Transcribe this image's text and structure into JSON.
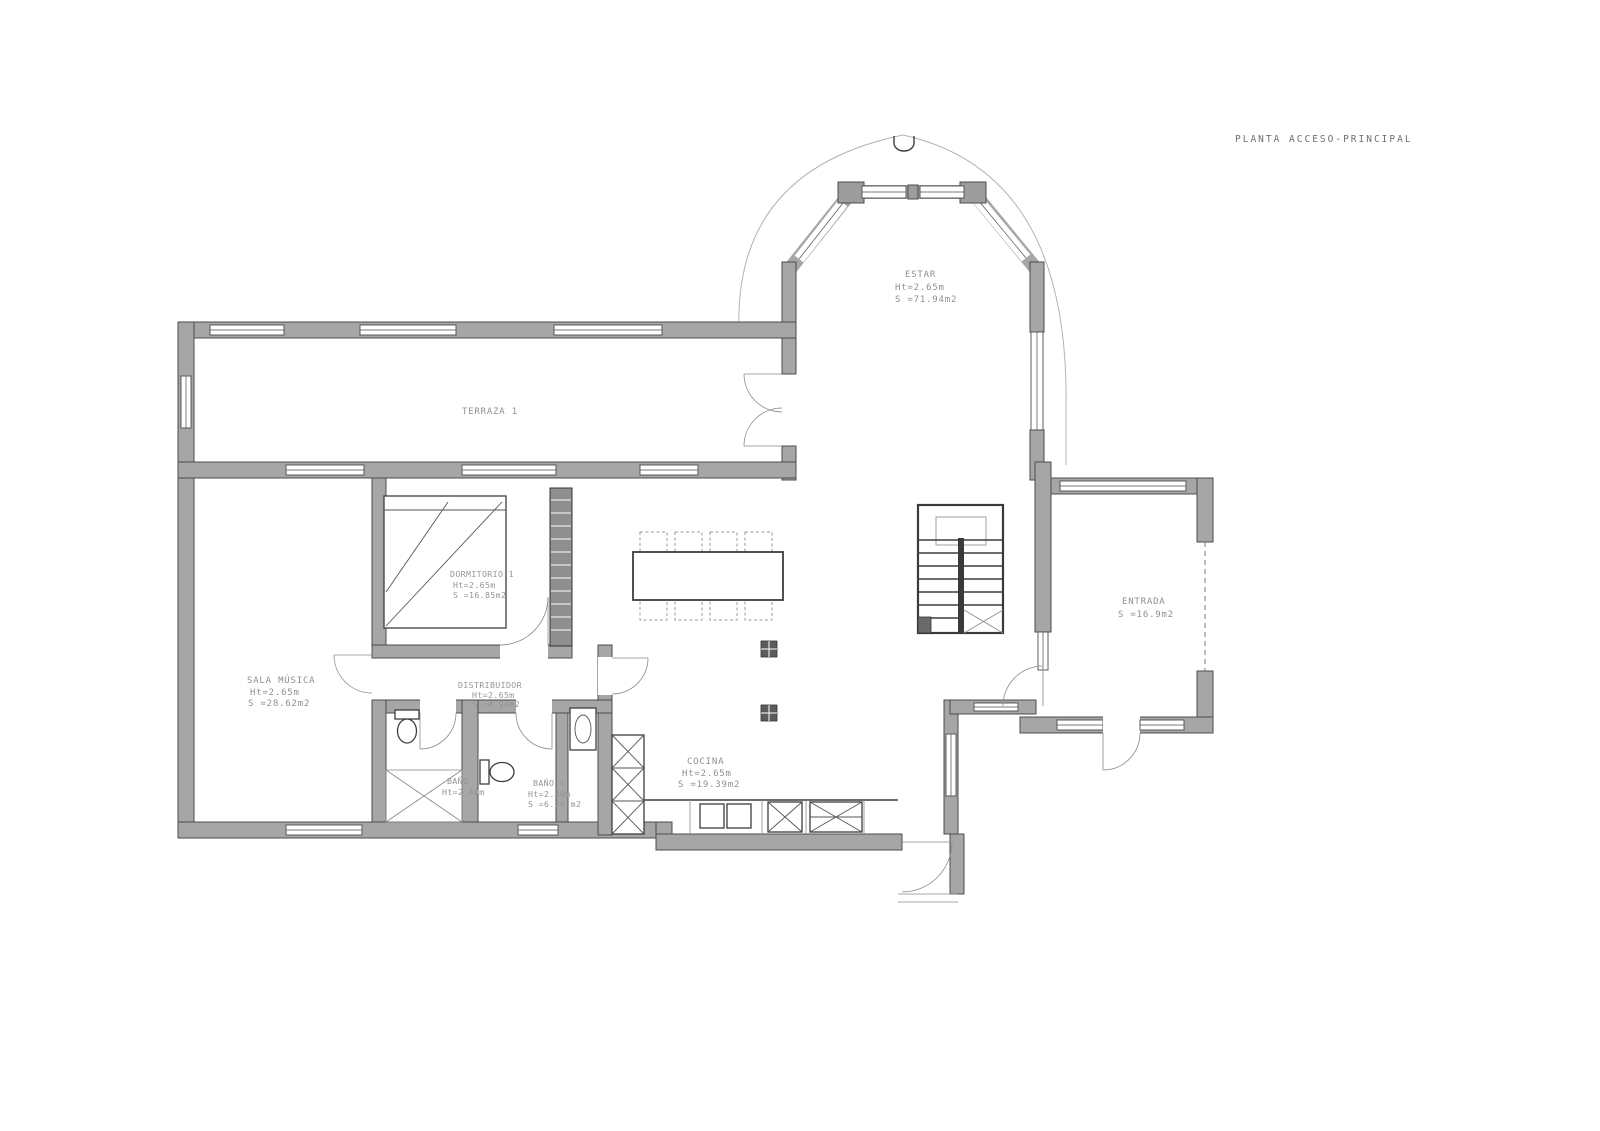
{
  "title": "PLANTA ACCESO-PRINCIPAL",
  "colors": {
    "wall_fill": "#a6a6a6",
    "wall_edge": "#4c4c4c",
    "label_text": "#8f8f8f",
    "paper": "#ffffff"
  },
  "rooms": {
    "estar": {
      "name": "ESTAR",
      "ht": "Ht=2.65m",
      "area": "S =71.94m2"
    },
    "terraza": {
      "name": "TERRAZA 1"
    },
    "dormitorio": {
      "name": "DORMITORIO 1",
      "ht": "Ht=2.65m",
      "area": "S =16.85m2"
    },
    "sala_musica": {
      "name": "SALA MÚSICA",
      "ht": "Ht=2.65m",
      "area": "S =28.62m2"
    },
    "distribuidor": {
      "name": "DISTRIBUIDOR",
      "ht": "Ht=2.65m",
      "area": "S =4.94m2"
    },
    "bano": {
      "name": "BAÑO",
      "ht": "Ht=2.40m"
    },
    "bano1": {
      "name": "BAÑO 1",
      "ht": "Ht=2.40m",
      "area": "S =6.20 m2"
    },
    "cocina": {
      "name": "COCINA",
      "ht": "Ht=2.65m",
      "area": "S =19.39m2"
    },
    "entrada": {
      "name": "ENTRADA",
      "area": "S =16.9m2"
    }
  }
}
